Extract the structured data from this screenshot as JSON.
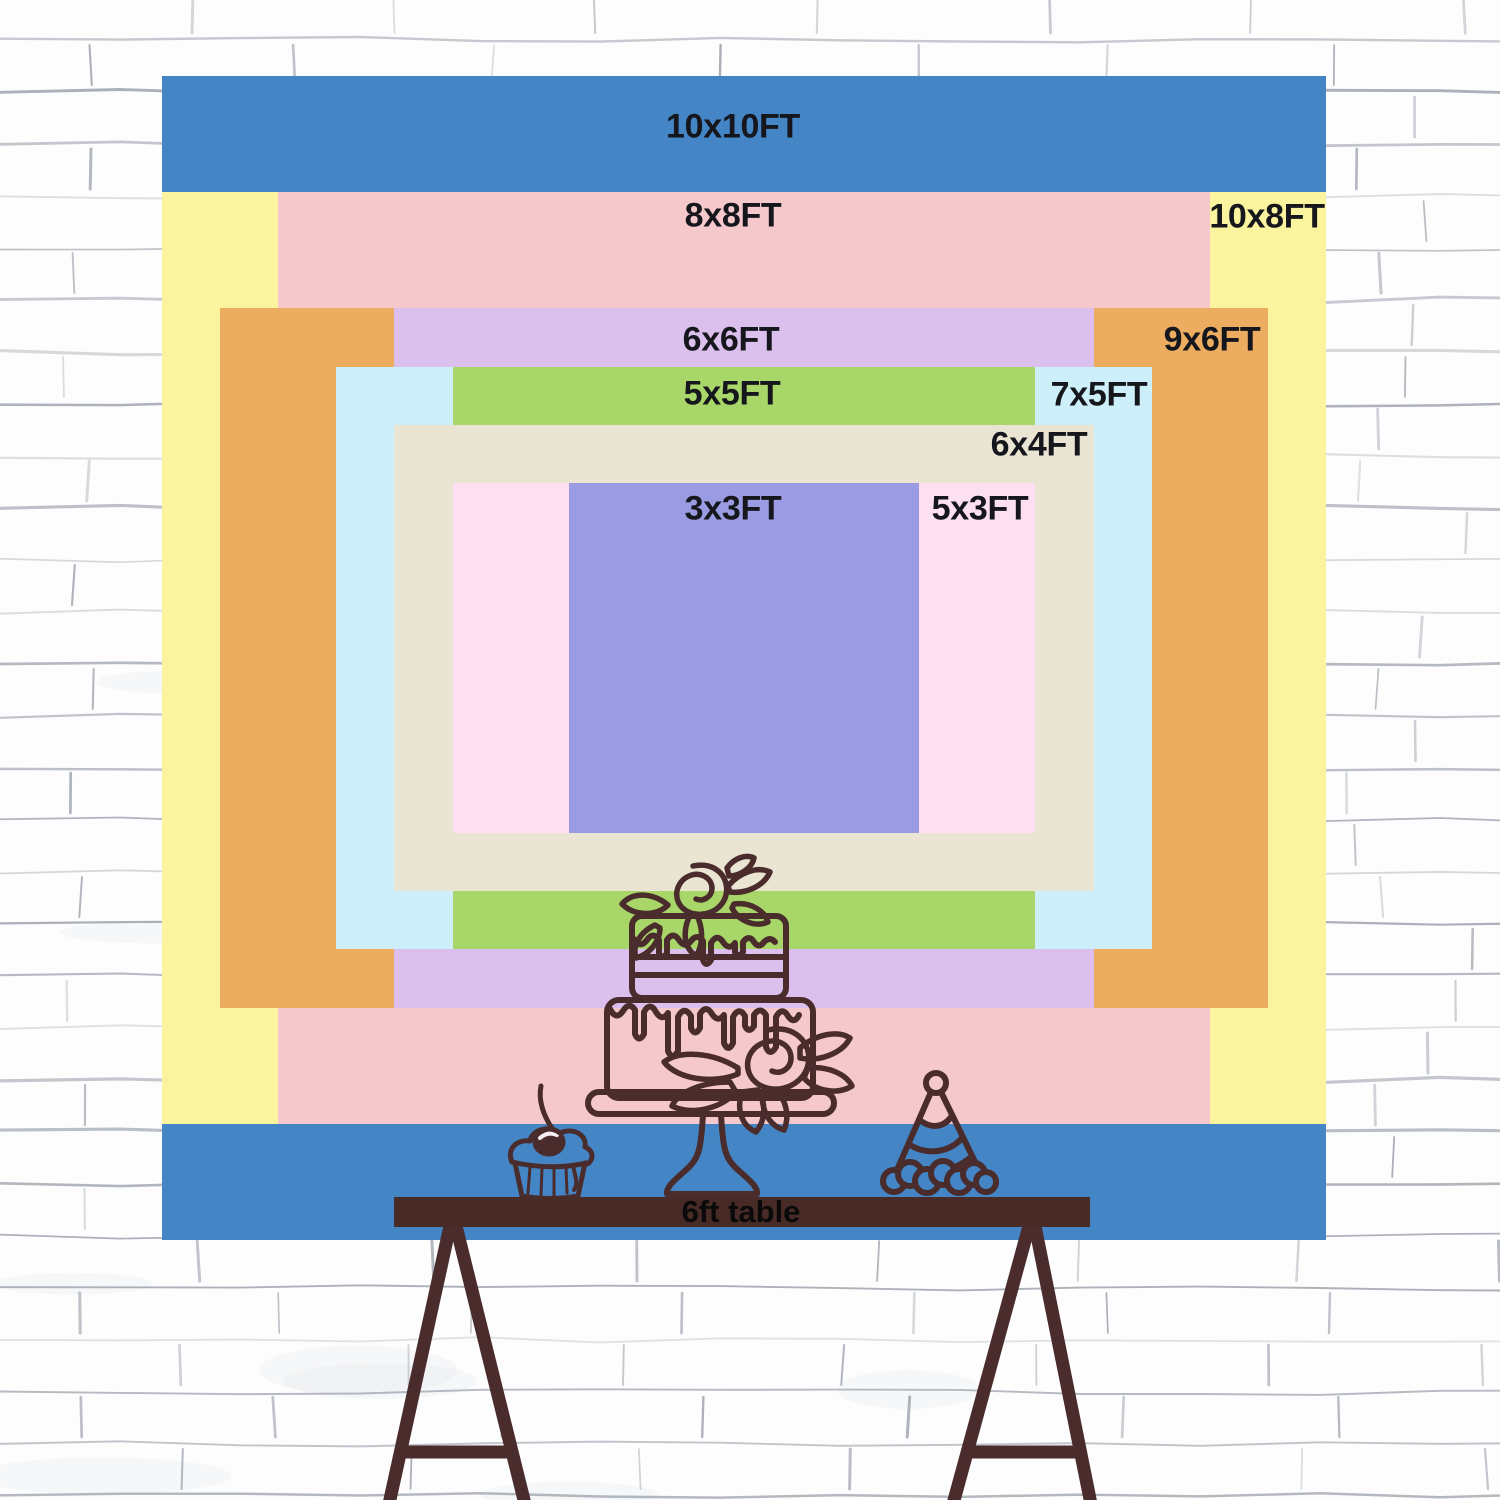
{
  "title": "backdrop size comparison chart",
  "sizes": [
    {
      "id": "10x10",
      "label": "10x10FT",
      "width_ft": 10,
      "height_ft": 10,
      "color": "#4486C5"
    },
    {
      "id": "10x8",
      "label": "10x8FT",
      "width_ft": 10,
      "height_ft": 8,
      "color": "#FAF49E"
    },
    {
      "id": "8x8",
      "label": "8x8FT",
      "width_ft": 8,
      "height_ft": 8,
      "color": "#F5C9CC"
    },
    {
      "id": "9x6",
      "label": "9x6FT",
      "width_ft": 9,
      "height_ft": 6,
      "color": "#EDAD60"
    },
    {
      "id": "6x6",
      "label": "6x6FT",
      "width_ft": 6,
      "height_ft": 6,
      "color": "#DBBFEC"
    },
    {
      "id": "7x5",
      "label": "7x5FT",
      "width_ft": 7,
      "height_ft": 5,
      "color": "#CDEFFA"
    },
    {
      "id": "5x5",
      "label": "5x5FT",
      "width_ft": 5,
      "height_ft": 5,
      "color": "#A9D669"
    },
    {
      "id": "6x4",
      "label": "6x4FT",
      "width_ft": 6,
      "height_ft": 4,
      "color": "#EAE5D3"
    },
    {
      "id": "5x3",
      "label": "5x3FT",
      "width_ft": 5,
      "height_ft": 3,
      "color": "#FCE0F2"
    },
    {
      "id": "3x3",
      "label": "3x3FT",
      "width_ft": 3,
      "height_ft": 3,
      "color": "#9A9BE2"
    }
  ],
  "table": {
    "label": "6ft table",
    "color": "#482A27"
  },
  "illustrations": {
    "items": [
      "two-tier-cake",
      "cupcake-with-cherry",
      "party-hat",
      "trestle-table"
    ],
    "line_color": "#4A2C2D"
  },
  "wall": {
    "style": "white sketched brick",
    "mortar_color": "#9BA1AB"
  }
}
